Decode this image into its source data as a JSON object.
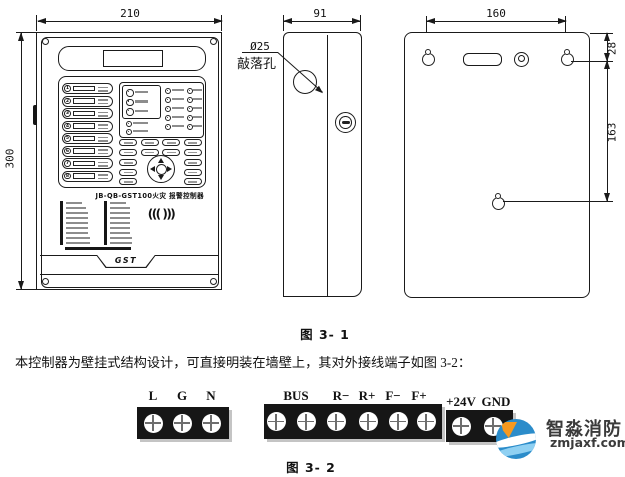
{
  "figure1": {
    "caption": "图 3- 1",
    "front_view": {
      "dim_width": "210",
      "dim_height": "300",
      "model_label": "JB-QB-GST100火灾 报警控制器",
      "brand_logo": "GST",
      "speaker_glyph": "((( )))",
      "zones": [
        "1",
        "2",
        "3",
        "4",
        "5",
        "6",
        "7",
        "8"
      ]
    },
    "side_view": {
      "dim_width": "91",
      "knockout_dia": "Ø25",
      "knockout_label": "敲落孔"
    },
    "back_view": {
      "dim_hole_span": "160",
      "dim_top_offset": "28",
      "dim_hole_drop": "163"
    }
  },
  "body_text": "本控制器为壁挂式结构设计，可直接明装在墙壁上，其对外接线端子如图 3-2：",
  "figure2": {
    "caption": "图 3- 2",
    "block1_labels": [
      "L",
      "G",
      "N"
    ],
    "block2_labels": [
      "BUS",
      "R−",
      "R+",
      "F−",
      "F+"
    ],
    "block3_labels": [
      "+24V",
      "GND"
    ]
  },
  "watermark": {
    "brand": "智淼消防",
    "site": "zmjaxf.com"
  },
  "colors": {
    "line": "#1a1a1a",
    "terminal_block": "#161616",
    "logo_blue": "#2b8cca",
    "logo_orange": "#f6991f"
  }
}
